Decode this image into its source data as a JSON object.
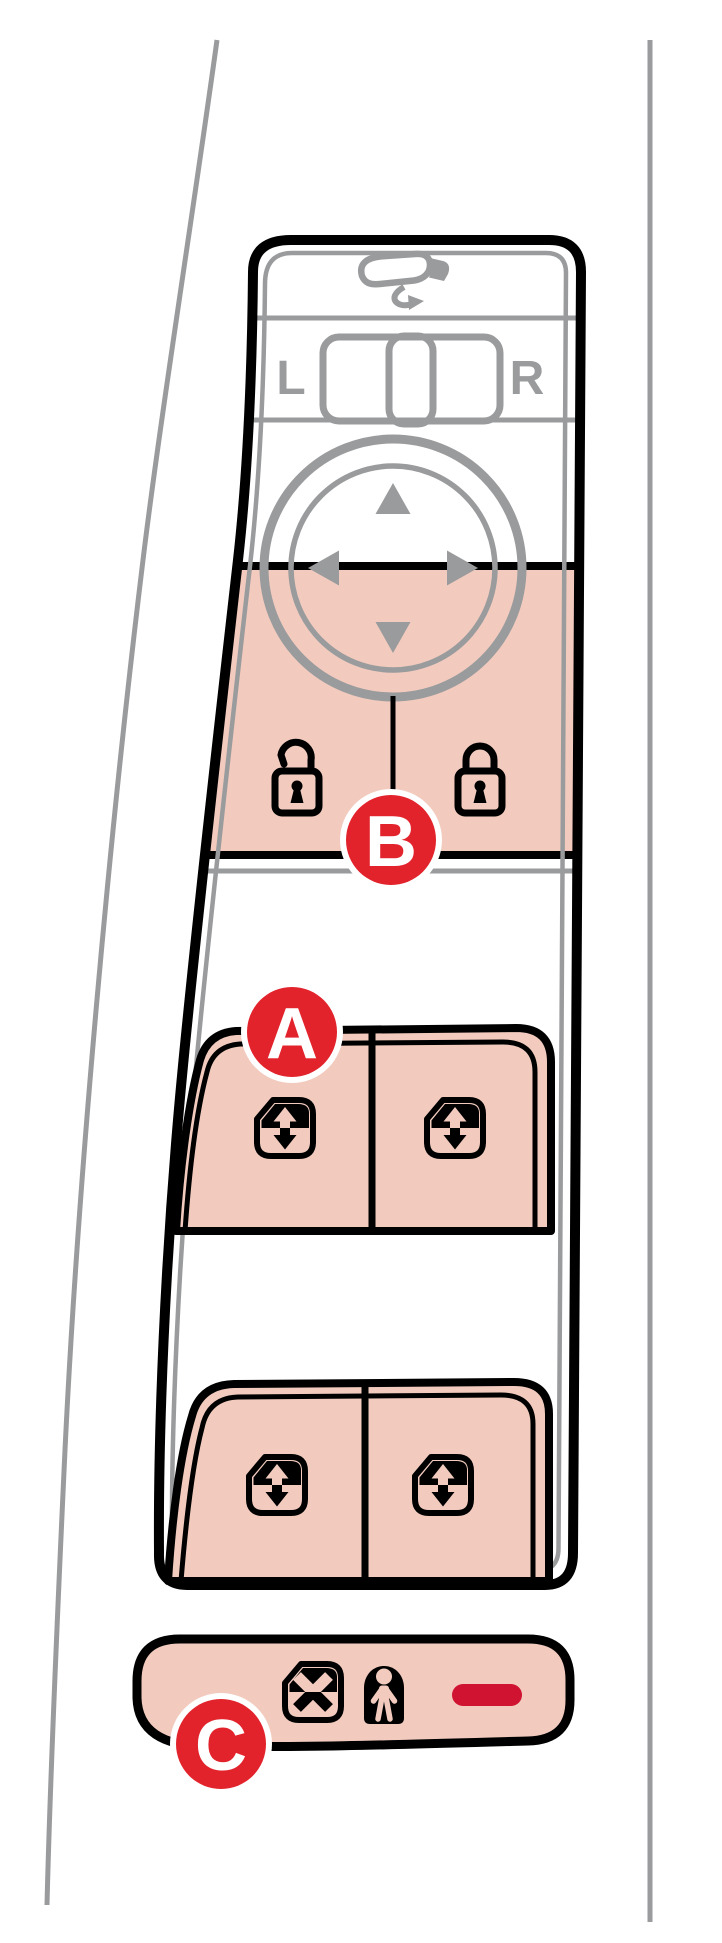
{
  "figure": {
    "title": "Driver door control panel illustration",
    "mirror_selector": {
      "left": "L",
      "right": "R"
    }
  },
  "callouts": {
    "a": "A",
    "b": "B",
    "c": "C"
  },
  "icons": {
    "top": "side-mirror-adjust-icon",
    "direction_pad": [
      "up-triangle-icon",
      "right-triangle-icon",
      "down-triangle-icon",
      "left-triangle-icon"
    ],
    "lock_buttons": [
      "unlock-padlock-icon",
      "lock-padlock-icon"
    ],
    "window_switches": "window-up-down-icon",
    "bottom_bar": [
      "window-lockout-icon",
      "child-safety-lock-icon",
      "indicator-light"
    ]
  },
  "colors": {
    "highlight_pink": "#F2CBBE",
    "line_gray": "#9A9B9D",
    "outline_black": "#000000",
    "callout_red": "#E2232C",
    "indicator_red": "#CF1330",
    "white": "#FFFFFF"
  }
}
